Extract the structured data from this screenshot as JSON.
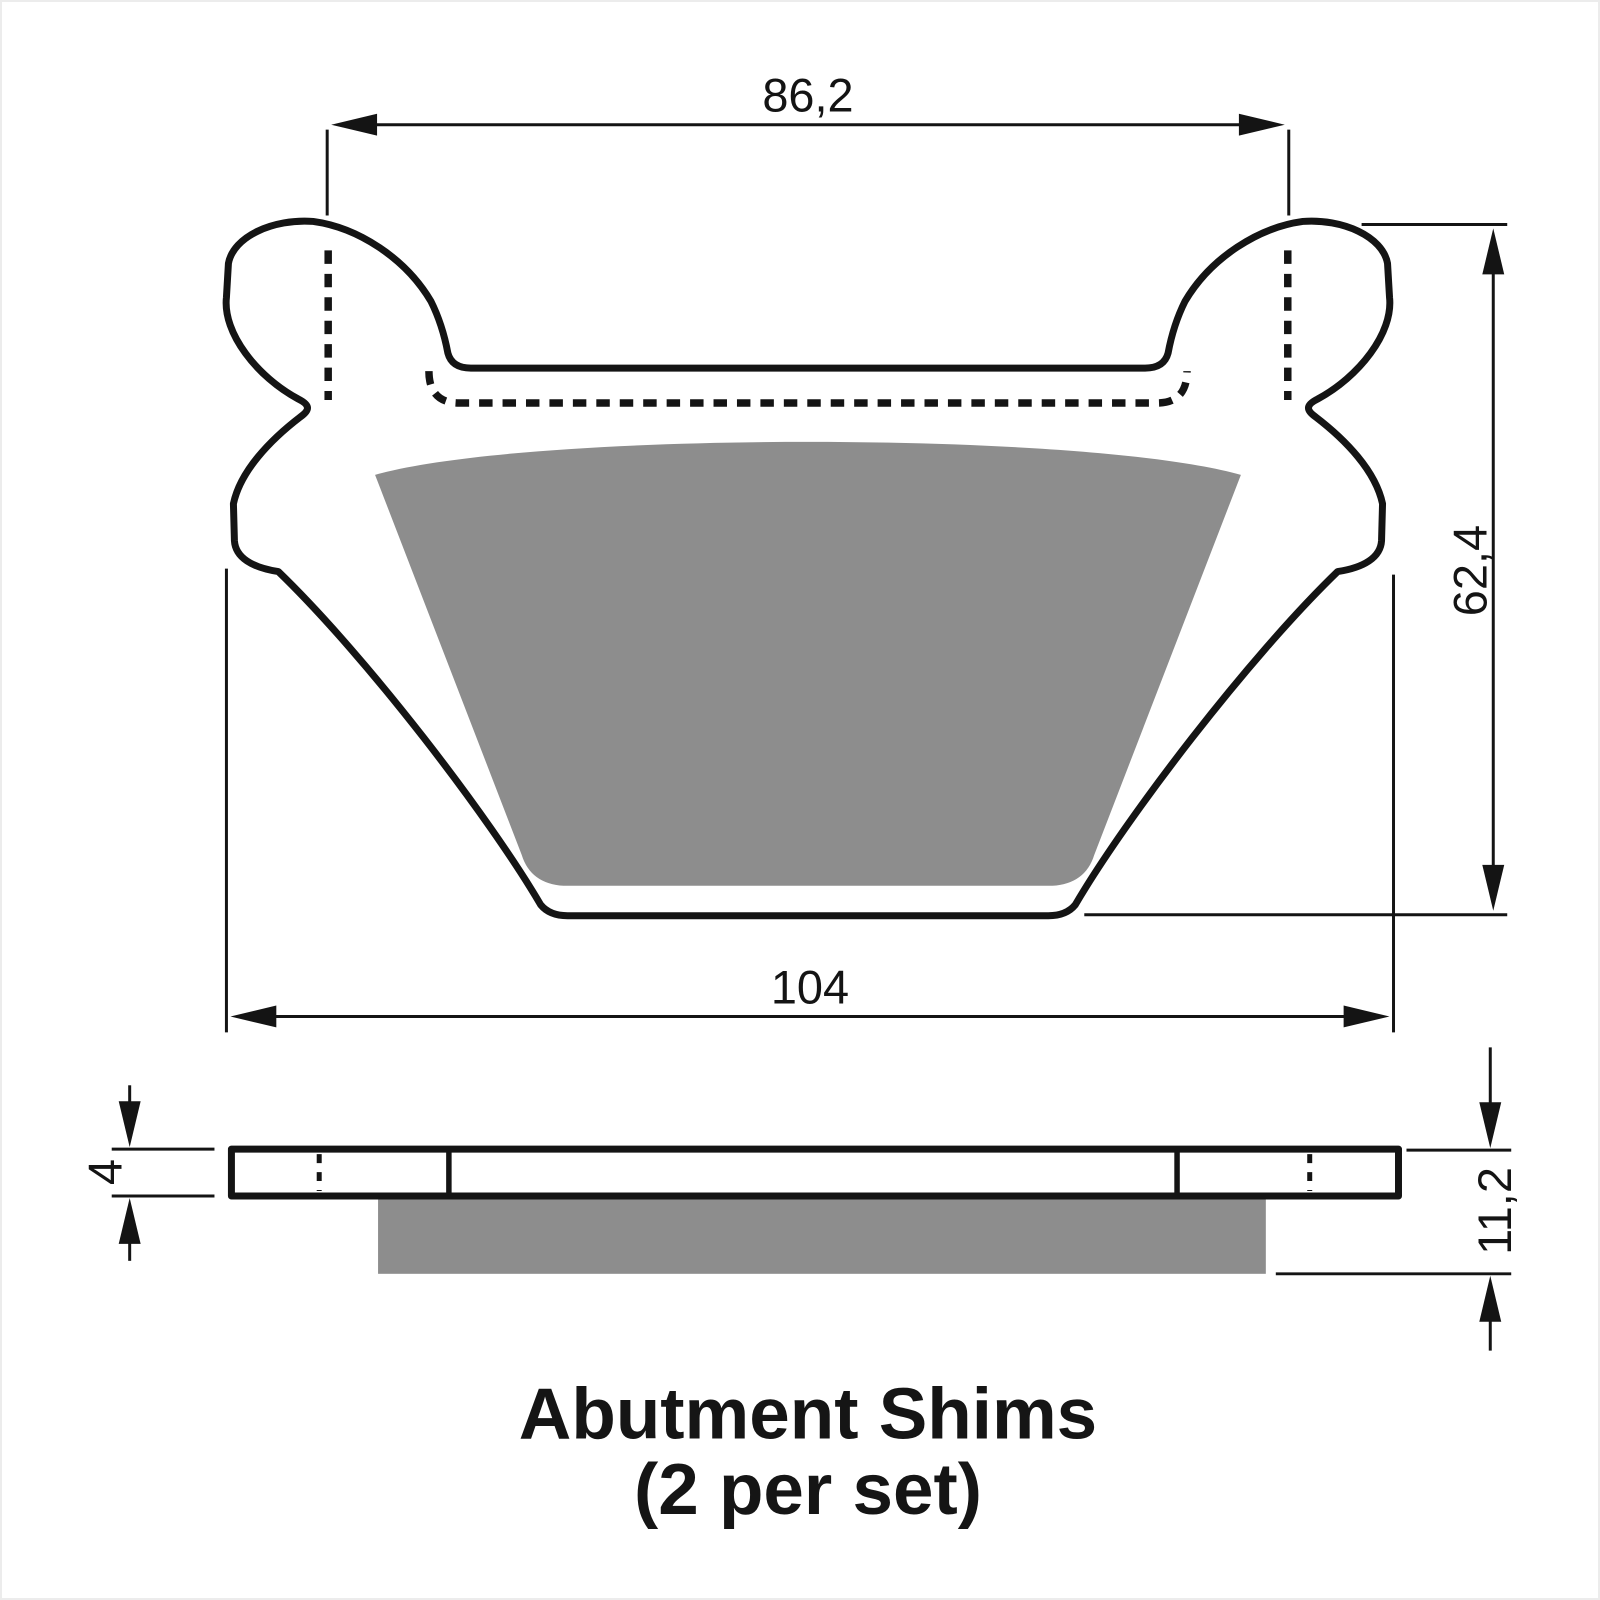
{
  "title": {
    "line1": "Abutment Shims",
    "line2": "(2 per set)"
  },
  "dimensions": {
    "top_width": "86,2",
    "bottom_width": "104",
    "overall_height": "62,4",
    "plate_thickness": "4",
    "total_thickness": "11,2"
  },
  "colors": {
    "line": "#141414",
    "friction_material": "#8d8d8d",
    "background": "#ffffff",
    "frame_border": "#ececec"
  }
}
